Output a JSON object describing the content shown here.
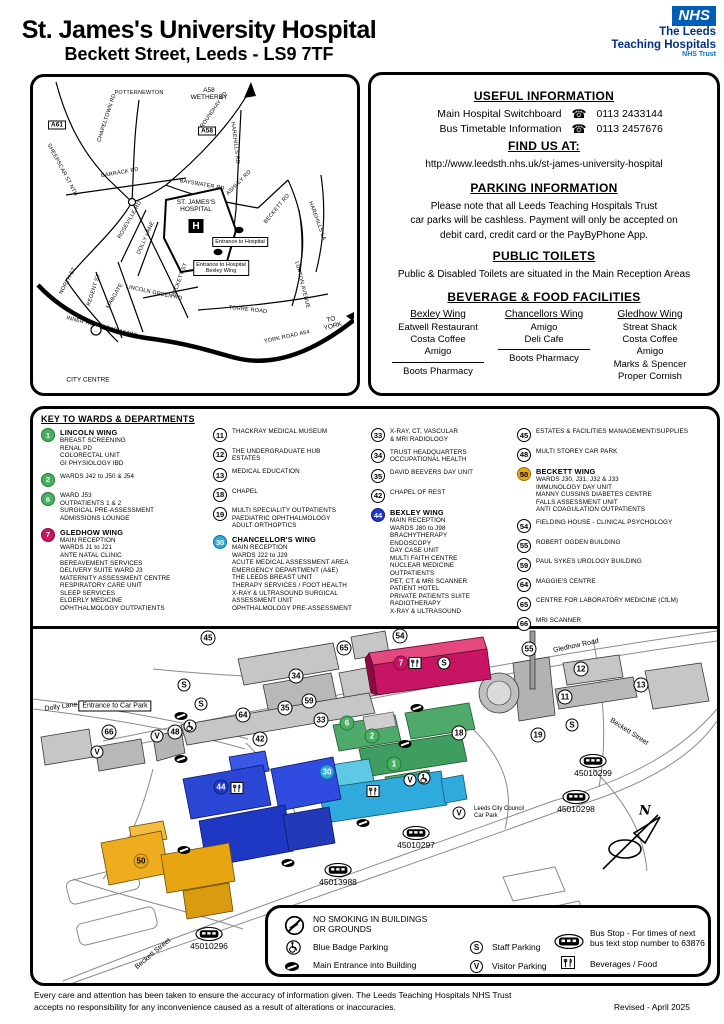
{
  "header": {
    "title": "St. James's University Hospital",
    "subtitle": "Beckett Street, Leeds - LS9 7TF",
    "nhs_logo": "NHS",
    "trust_line1": "The Leeds",
    "trust_line2": "Teaching Hospitals",
    "trust_line3": "NHS Trust"
  },
  "colors": {
    "nhs_blue": "#005EB8",
    "lincoln_green": "#4CAE63",
    "gledhow_magenta": "#C71563",
    "chancellor_cyan": "#2FAADC",
    "bexley_blue": "#2038C8",
    "beckett_gold": "#E8A61A"
  },
  "road_map": {
    "labels": [
      {
        "label": "POTTERNEWTON",
        "x": 103,
        "y": 13,
        "cls": "rm-road"
      },
      {
        "label": "A58\nWETHERBY",
        "x": 173,
        "y": 14,
        "cls": "rm-plain"
      },
      {
        "label": "A61",
        "x": 21,
        "y": 45,
        "cls": "rm-badge"
      },
      {
        "label": "A58",
        "x": 171,
        "y": 51,
        "cls": "rm-badge"
      },
      {
        "label": "CHAPELTOWN RD",
        "x": 71,
        "y": 38,
        "cls": "rm-road",
        "rot": -72
      },
      {
        "label": "ROUNDHAY RD",
        "x": 178,
        "y": 30,
        "cls": "rm-road",
        "rot": -55
      },
      {
        "label": "HAREHILLS RD",
        "x": 199,
        "y": 63,
        "cls": "rm-road",
        "rot": 83
      },
      {
        "label": "BARRACK RD",
        "x": 84,
        "y": 93,
        "cls": "rm-road",
        "rot": -10
      },
      {
        "label": "SHEEPSCAR ST NTH",
        "x": 26,
        "y": 90,
        "cls": "rm-road",
        "rot": 62
      },
      {
        "label": "BAYSWATER RD",
        "x": 166,
        "y": 105,
        "cls": "rm-road",
        "rot": 10
      },
      {
        "label": "ASHLEY RD",
        "x": 203,
        "y": 103,
        "cls": "rm-road",
        "rot": -45
      },
      {
        "label": "BECKETT RD",
        "x": 241,
        "y": 129,
        "cls": "rm-road",
        "rot": -50
      },
      {
        "label": "HAREHILLS LA",
        "x": 281,
        "y": 141,
        "cls": "rm-road",
        "rot": 70
      },
      {
        "label": "ST. JAMES'S\nHOSPITAL",
        "x": 160,
        "y": 126,
        "cls": "rm-hosp"
      },
      {
        "label": "H",
        "x": 160,
        "y": 146,
        "cls": "rm-h"
      },
      {
        "label": "Entrance to Hospital",
        "x": 204,
        "y": 162,
        "cls": "rm-box"
      },
      {
        "label": "Entrance to Hospital\nBexley Wing",
        "x": 185,
        "y": 188,
        "cls": "rm-box"
      },
      {
        "label": "ROSEVILLE RD",
        "x": 94,
        "y": 140,
        "cls": "rm-road",
        "rot": -60
      },
      {
        "label": "DOLLY LANE",
        "x": 110,
        "y": 158,
        "cls": "rm-road",
        "rot": -66
      },
      {
        "label": "BECKETT ST",
        "x": 144,
        "y": 200,
        "cls": "rm-road",
        "rot": -70
      },
      {
        "label": "NORTH ST",
        "x": 32,
        "y": 201,
        "cls": "rm-road",
        "rot": -62
      },
      {
        "label": "REGENT ST",
        "x": 58,
        "y": 210,
        "cls": "rm-road",
        "rot": -72
      },
      {
        "label": "MABGATE",
        "x": 79,
        "y": 216,
        "cls": "rm-road",
        "rot": -60
      },
      {
        "label": "LINCOLN GREEN RD",
        "x": 118,
        "y": 213,
        "cls": "rm-road",
        "rot": 12
      },
      {
        "label": "LUPTON AVENUE",
        "x": 266,
        "y": 205,
        "cls": "rm-road",
        "rot": 76
      },
      {
        "label": "TORRE ROAD",
        "x": 212,
        "y": 230,
        "cls": "rm-road",
        "rot": 6
      },
      {
        "label": "INNER RING ROAD A64(M)",
        "x": 66,
        "y": 247,
        "cls": "rm-road",
        "rot": 14
      },
      {
        "label": "YORK ROAD A64",
        "x": 251,
        "y": 257,
        "cls": "rm-road",
        "rot": -12
      },
      {
        "label": "TO YORK",
        "x": 296,
        "y": 243,
        "cls": "rm-plain",
        "rot": -14
      },
      {
        "label": "CITY CENTRE",
        "x": 52,
        "y": 300,
        "cls": "rm-plain"
      }
    ]
  },
  "info": {
    "useful_title": "USEFUL INFORMATION",
    "rows": [
      {
        "label": "Main Hospital Switchboard",
        "icon": "☎",
        "phone": "0113 2433144"
      },
      {
        "label": "Bus Timetable Information",
        "icon": "☎",
        "phone": "0113 2457676"
      }
    ],
    "find_title": "FIND US AT:",
    "url": "http://www.leedsth.nhs.uk/st-james-university-hospital",
    "parking_title": "PARKING INFORMATION",
    "parking_text": "Please note that all Leeds Teaching Hospitals Trust\ncar parks will be cashless. Payment will only be accepted on\ndebit card, credit card or the PayByPhone App.",
    "toilets_title": "PUBLIC TOILETS",
    "toilets_text": "Public & Disabled Toilets are situated in the Main Reception Areas",
    "food_title": "BEVERAGE & FOOD FACILITIES",
    "food_columns": [
      {
        "wing": "Bexley Wing",
        "items": "Eatwell Restaurant\nCosta Coffee\nAmigo",
        "below": "Boots Pharmacy"
      },
      {
        "wing": "Chancellors Wing",
        "items": "Amigo\nDeli Cafe",
        "below": "Boots Pharmacy"
      },
      {
        "wing": "Gledhow Wing",
        "items": "Streat Shack\nCosta Coffee\nAmigo\nMarks & Spencer\nProper Cornish",
        "below": ""
      }
    ]
  },
  "key": {
    "title": "KEY TO WARDS & DEPARTMENTS",
    "columns": {
      "c1": [
        {
          "num": "1",
          "fill": "#4CAE63",
          "border": "#1E7A3C",
          "tcolor": "#fff",
          "title": "LINCOLN WING",
          "lines": "BREAST SCREENING\nRENAL PD\nCOLORECTAL UNIT\nGI PHYSIOLOGY IBD"
        },
        {
          "num": "2",
          "fill": "#4CAE63",
          "border": "#1E7A3C",
          "tcolor": "#fff",
          "title": "",
          "lines": "WARDS J42 to J50 & J54"
        },
        {
          "num": "6",
          "fill": "#4CAE63",
          "border": "#1E7A3C",
          "tcolor": "#fff",
          "title": "",
          "lines": "WARD J53\nOUTPATIENTS 1 & 2\nSURGICAL PRE-ASSESSMENT\nADMISSIONS LOUNGE"
        },
        {
          "num": "7",
          "fill": "#C71563",
          "border": "#8C0A43",
          "tcolor": "#fff",
          "title": "GLEDHOW WING",
          "lines": "MAIN RECEPTION\nWARDS J1 to J21\nANTE NATAL CLINIC\nBEREAVEMENT SERVICES\nDELIVERY SUITE WARD J3\nMATERNITY ASSESSMENT CENTRE\nRESPIRATORY CARE UNIT\nSLEEP SERVICES\nELDERLY MEDICINE\nOPHTHALMOLOGY OUTPATIENTS"
        }
      ],
      "c2": [
        {
          "num": "11",
          "fill": "#fff",
          "border": "#000",
          "tcolor": "#000",
          "title": "",
          "lines": "THACKRAY MEDICAL MUSEUM"
        },
        {
          "num": "12",
          "fill": "#fff",
          "border": "#000",
          "tcolor": "#000",
          "title": "",
          "lines": "THE UNDERGRADUATE HUB\nESTATES"
        },
        {
          "num": "13",
          "fill": "#fff",
          "border": "#000",
          "tcolor": "#000",
          "title": "",
          "lines": "MEDICAL EDUCATION"
        },
        {
          "num": "18",
          "fill": "#fff",
          "border": "#000",
          "tcolor": "#000",
          "title": "",
          "lines": "CHAPEL"
        },
        {
          "num": "19",
          "fill": "#fff",
          "border": "#000",
          "tcolor": "#000",
          "title": "",
          "lines": "MULTI SPECIALITY OUTPATIENTS\nPAEDIATRIC OPHTHALMOLOGY\nADULT ORTHOPTICS"
        },
        {
          "num": "30",
          "fill": "#2FAADC",
          "border": "#15719A",
          "tcolor": "#fff",
          "title": "CHANCELLOR'S WING",
          "lines": "MAIN RECEPTION\nWARDS J22 to J29\nACUTE MEDICAL ASSESSMENT AREA\nEMERGENCY DEPARTMENT (A&E)\nTHE LEEDS BREAST UNIT\nTHERAPY SERVICES / FOOT HEALTH\nX-RAY & ULTRASOUND SURGICAL\nASSESSMENT UNIT\nOPHTHALMOLOGY PRE-ASSESSMENT"
        }
      ],
      "c3": [
        {
          "num": "33",
          "fill": "#fff",
          "border": "#000",
          "tcolor": "#000",
          "title": "",
          "lines": "X-RAY, CT, VASCULAR\n& MRI RADIOLOGY"
        },
        {
          "num": "34",
          "fill": "#fff",
          "border": "#000",
          "tcolor": "#000",
          "title": "",
          "lines": "TRUST HEADQUARTERS\nOCCUPATIONAL HEALTH"
        },
        {
          "num": "35",
          "fill": "#fff",
          "border": "#000",
          "tcolor": "#000",
          "title": "",
          "lines": "DAVID BEEVERS DAY UNIT"
        },
        {
          "num": "42",
          "fill": "#fff",
          "border": "#000",
          "tcolor": "#000",
          "title": "",
          "lines": "CHAPEL OF REST"
        },
        {
          "num": "44",
          "fill": "#2038C8",
          "border": "#101E78",
          "tcolor": "#fff",
          "title": "BEXLEY WING",
          "lines": "MAIN RECEPTION\nWARDS J80 to J98\nBRACHYTHERAPY\nENDOSCOPY\nDAY CASE UNIT\nMULTI FAITH CENTRE\nNUCLEAR MEDICINE\nOUTPATIENTS\nPET, CT & MRI SCANNER\nPATIENT HOTEL\nPRIVATE PATIENTS SUITE\nRADIOTHERAPY\nX-RAY & ULTRASOUND"
        }
      ],
      "c4": [
        {
          "num": "45",
          "fill": "#fff",
          "border": "#000",
          "tcolor": "#000",
          "title": "",
          "lines": "ESTATES & FACILITIES MANAGEMENT/SUPPLIES"
        },
        {
          "num": "48",
          "fill": "#fff",
          "border": "#000",
          "tcolor": "#000",
          "title": "",
          "lines": "MULTI STOREY CAR PARK"
        },
        {
          "num": "50",
          "fill": "#E8A61A",
          "border": "#9C6D05",
          "tcolor": "#000",
          "title": "BECKETT WING",
          "lines": "WARDS J30, J31, J32 & J33\nIMMUNOLOGY DAY UNIT\nMANNY CUSSINS DIABETES CENTRE\nFALLS ASSESSMENT UNIT\nANTI COAGULATION OUTPATIENTS"
        },
        {
          "num": "54",
          "fill": "#fff",
          "border": "#000",
          "tcolor": "#000",
          "title": "",
          "lines": "FIELDING HOUSE - CLINICAL PSYCHOLOGY"
        },
        {
          "num": "55",
          "fill": "#fff",
          "border": "#000",
          "tcolor": "#000",
          "title": "",
          "lines": "ROBERT OGDEN BUILDING"
        },
        {
          "num": "59",
          "fill": "#fff",
          "border": "#000",
          "tcolor": "#000",
          "title": "",
          "lines": "PAUL SYKES UROLOGY BUILDING"
        },
        {
          "num": "64",
          "fill": "#fff",
          "border": "#000",
          "tcolor": "#000",
          "title": "",
          "lines": "MAGGIE'S CENTRE"
        },
        {
          "num": "65",
          "fill": "#fff",
          "border": "#000",
          "tcolor": "#000",
          "title": "",
          "lines": "CENTRE FOR LABORATORY MEDICINE (CfLM)"
        },
        {
          "num": "66",
          "fill": "#fff",
          "border": "#000",
          "tcolor": "#000",
          "title": "",
          "lines": "MRI SCANNER"
        }
      ]
    }
  },
  "map": {
    "circles": [
      {
        "label": "45",
        "x": 175,
        "y": 9,
        "fill": "#fff",
        "border": "#000",
        "tcolor": "#000"
      },
      {
        "label": "65",
        "x": 311,
        "y": 19,
        "fill": "#fff",
        "border": "#000",
        "tcolor": "#000"
      },
      {
        "label": "54",
        "x": 367,
        "y": 7,
        "fill": "#fff",
        "border": "#000",
        "tcolor": "#000"
      },
      {
        "label": "55",
        "x": 496,
        "y": 20,
        "fill": "#fff",
        "border": "#000",
        "tcolor": "#000"
      },
      {
        "label": "12",
        "x": 548,
        "y": 40,
        "fill": "#fff",
        "border": "#000",
        "tcolor": "#000"
      },
      {
        "label": "13",
        "x": 608,
        "y": 56,
        "fill": "#fff",
        "border": "#000",
        "tcolor": "#000"
      },
      {
        "label": "11",
        "x": 532,
        "y": 68,
        "fill": "#fff",
        "border": "#000",
        "tcolor": "#000"
      },
      {
        "label": "34",
        "x": 263,
        "y": 47,
        "fill": "#fff",
        "border": "#000",
        "tcolor": "#000"
      },
      {
        "label": "59",
        "x": 276,
        "y": 72,
        "fill": "#fff",
        "border": "#000",
        "tcolor": "#000"
      },
      {
        "label": "35",
        "x": 252,
        "y": 79,
        "fill": "#fff",
        "border": "#000",
        "tcolor": "#000"
      },
      {
        "label": "33",
        "x": 288,
        "y": 91,
        "fill": "#fff",
        "border": "#000",
        "tcolor": "#000"
      },
      {
        "label": "64",
        "x": 210,
        "y": 86,
        "fill": "#fff",
        "border": "#000",
        "tcolor": "#000"
      },
      {
        "label": "42",
        "x": 227,
        "y": 110,
        "fill": "#fff",
        "border": "#000",
        "tcolor": "#000"
      },
      {
        "label": "7",
        "x": 368,
        "y": 34,
        "fill": "#C71563",
        "border": "#8C0A43",
        "tcolor": "#fff"
      },
      {
        "label": "66",
        "x": 76,
        "y": 103,
        "fill": "#fff",
        "border": "#000",
        "tcolor": "#000"
      },
      {
        "label": "48",
        "x": 142,
        "y": 103,
        "fill": "#fff",
        "border": "#000",
        "tcolor": "#000"
      },
      {
        "label": "18",
        "x": 426,
        "y": 104,
        "fill": "#fff",
        "border": "#000",
        "tcolor": "#000"
      },
      {
        "label": "19",
        "x": 505,
        "y": 106,
        "fill": "#fff",
        "border": "#000",
        "tcolor": "#000"
      },
      {
        "label": "6",
        "x": 314,
        "y": 94,
        "fill": "#4CAE63",
        "border": "#1E7A3C",
        "tcolor": "#fff"
      },
      {
        "label": "2",
        "x": 339,
        "y": 107,
        "fill": "#4CAE63",
        "border": "#1E7A3C",
        "tcolor": "#fff"
      },
      {
        "label": "1",
        "x": 361,
        "y": 135,
        "fill": "#4CAE63",
        "border": "#1E7A3C",
        "tcolor": "#fff"
      },
      {
        "label": "30",
        "x": 294,
        "y": 143,
        "fill": "#2FAADC",
        "border": "#15719A",
        "tcolor": "#fff"
      },
      {
        "label": "44",
        "x": 188,
        "y": 158,
        "fill": "#2038C8",
        "border": "#101E78",
        "tcolor": "#fff"
      },
      {
        "label": "50",
        "x": 108,
        "y": 232,
        "fill": "#E8A61A",
        "border": "#9C6D05",
        "tcolor": "#000"
      }
    ],
    "parking": [
      {
        "label": "S",
        "x": 151,
        "y": 56
      },
      {
        "label": "S",
        "x": 168,
        "y": 75
      },
      {
        "label": "S",
        "x": 411,
        "y": 34
      },
      {
        "label": "S",
        "x": 539,
        "y": 96
      },
      {
        "label": "V",
        "x": 124,
        "y": 107
      },
      {
        "label": "V",
        "x": 64,
        "y": 123
      },
      {
        "label": "V",
        "x": 377,
        "y": 151
      },
      {
        "label": "V",
        "x": 426,
        "y": 184
      }
    ],
    "badges": [
      {
        "x": 157,
        "y": 97
      },
      {
        "x": 391,
        "y": 149
      }
    ],
    "food": [
      {
        "x": 382,
        "y": 34
      },
      {
        "x": 204,
        "y": 159
      },
      {
        "x": 340,
        "y": 162
      }
    ],
    "entrances": [
      {
        "x": 148,
        "y": 87
      },
      {
        "x": 148,
        "y": 130
      },
      {
        "x": 384,
        "y": 79
      },
      {
        "x": 372,
        "y": 115
      },
      {
        "x": 151,
        "y": 221
      },
      {
        "x": 330,
        "y": 194
      },
      {
        "x": 255,
        "y": 234
      }
    ],
    "bus_stops": [
      {
        "label": "45010299",
        "x": 560,
        "y": 137
      },
      {
        "label": "45010298",
        "x": 543,
        "y": 173
      },
      {
        "label": "45010297",
        "x": 383,
        "y": 209
      },
      {
        "label": "45013988",
        "x": 305,
        "y": 246
      },
      {
        "label": "45010296",
        "x": 176,
        "y": 310
      }
    ],
    "labels": [
      {
        "label": "Gledhow Road",
        "x": 543,
        "y": 17,
        "cls": "m-road",
        "rot": -12
      },
      {
        "label": "Dolly Lane",
        "x": 28,
        "y": 78,
        "cls": "m-road",
        "rot": -8
      },
      {
        "label": "Beckett Street",
        "x": 596,
        "y": 103,
        "cls": "m-road",
        "rot": 33
      },
      {
        "label": "Beckett Street",
        "x": 120,
        "y": 325,
        "cls": "m-road",
        "rot": -40
      },
      {
        "label": "Entrance to Car Park",
        "x": 82,
        "y": 77,
        "cls": "m-boxlabel"
      },
      {
        "label": "Leeds City Council\nCar Park",
        "x": 466,
        "y": 184,
        "cls": "m-smalllabel"
      },
      {
        "label": "N",
        "x": 612,
        "y": 182,
        "cls": "m-compassn"
      }
    ]
  },
  "legend": {
    "no_smoking": "NO SMOKING IN BUILDINGS\nOR GROUNDS",
    "blue_badge": "Blue Badge Parking",
    "main_entrance": "Main Entrance into Building",
    "staff_symbol": "S",
    "staff": "Staff Parking",
    "visitor_symbol": "V",
    "visitor": "Visitor Parking",
    "bus_stop": "Bus Stop - For times of next\nbus text stop number to 63876",
    "food": "Beverages / Food"
  },
  "footer": {
    "disclaimer": "Every care and attention has been taken to ensure the accuracy of information given. The Leeds Teaching Hospitals NHS Trust\naccepts no responsibility for any inconvenience caused as a result of alterations or inaccuracies.",
    "revised": "Revised - April 2025"
  }
}
